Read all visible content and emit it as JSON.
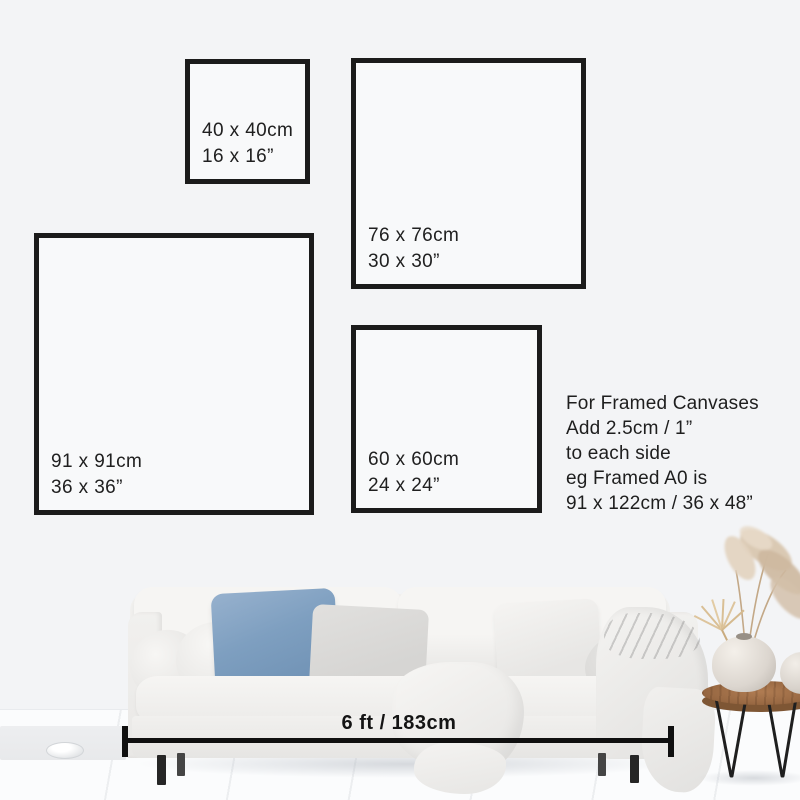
{
  "frames": [
    {
      "cm": "40 x 40cm",
      "inch": "16 x 16”"
    },
    {
      "cm": "76 x 76cm",
      "inch": "30 x 30”"
    },
    {
      "cm": "91 x 91cm",
      "inch": "36 x 36”"
    },
    {
      "cm": "60 x 60cm",
      "inch": "24 x 24”"
    }
  ],
  "note": {
    "lines": [
      "For Framed Canvases",
      "Add 2.5cm / 1”",
      "to each side",
      "eg Framed A0 is",
      "91 x 122cm / 36 x 48”"
    ]
  },
  "measurement": {
    "label": "6 ft / 183cm"
  },
  "colors": {
    "wall": "#f3f4f6",
    "floor": "#fbfcfd",
    "frame_border": "#1b1b1b",
    "text": "#202020",
    "pillow_blue": "#7e9fc0",
    "table_wood": "#9a6a44",
    "measure_line": "#101010"
  }
}
